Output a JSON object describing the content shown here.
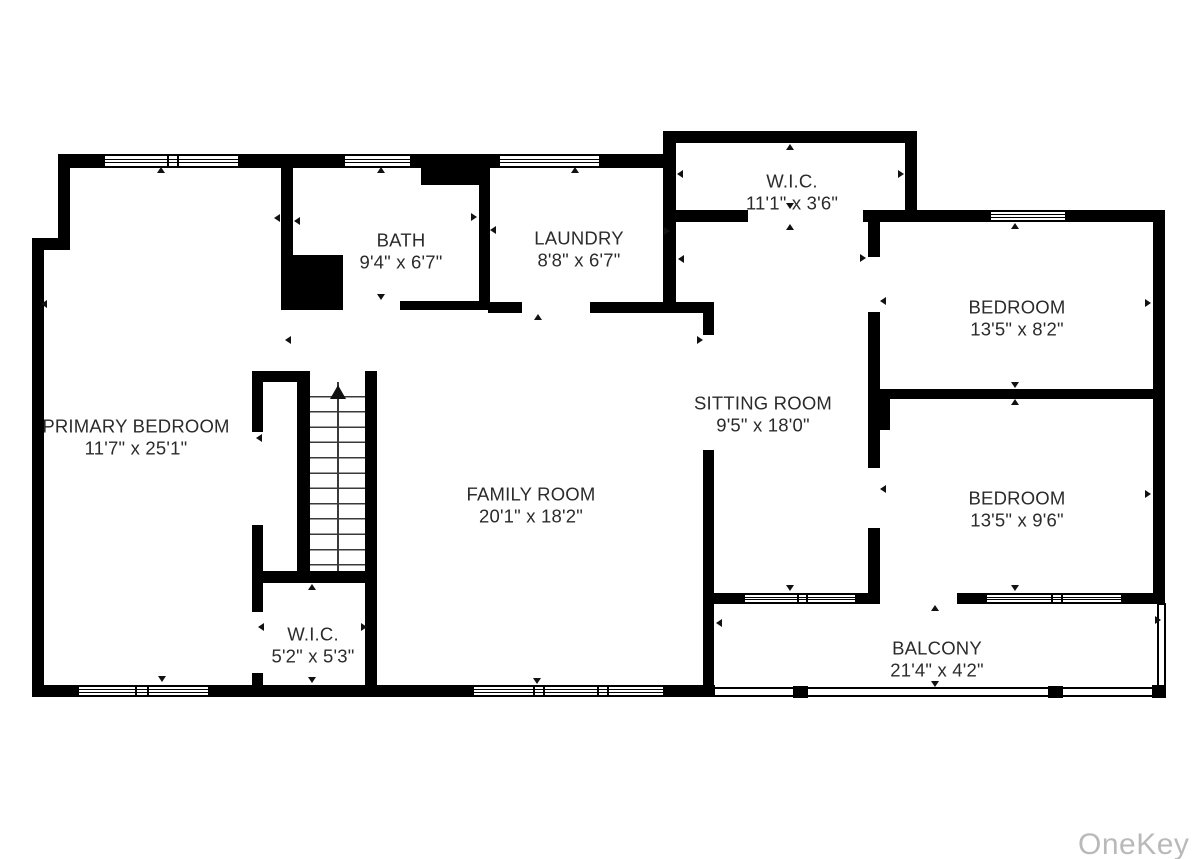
{
  "watermark": "OneKey MLS",
  "stairs": {
    "direction_icon": "up-arrow"
  },
  "rooms": {
    "primary_bedroom": {
      "name": "PRIMARY BEDROOM",
      "dims": "11'7\" x 25'1\""
    },
    "bath": {
      "name": "BATH",
      "dims": "9'4\" x 6'7\""
    },
    "laundry": {
      "name": "LAUNDRY",
      "dims": "8'8\" x 6'7\""
    },
    "wic_top": {
      "name": "W.I.C.",
      "dims": "11'1\" x 3'6\""
    },
    "sitting_room": {
      "name": "SITTING ROOM",
      "dims": "9'5\" x 18'0\""
    },
    "bedroom_1": {
      "name": "BEDROOM",
      "dims": "13'5\" x 8'2\""
    },
    "bedroom_2": {
      "name": "BEDROOM",
      "dims": "13'5\" x 9'6\""
    },
    "family_room": {
      "name": "FAMILY ROOM",
      "dims": "20'1\" x 18'2\""
    },
    "wic_small": {
      "name": "W.I.C.",
      "dims": "5'2\" x 5'3\""
    },
    "balcony": {
      "name": "BALCONY",
      "dims": "21'4\" x 4'2\""
    }
  },
  "colors": {
    "wall": "#000000",
    "label": "#2b2b2b",
    "watermark": "#b9b9b9"
  },
  "markers": [
    {
      "x": 161,
      "y": 170,
      "dir": "up"
    },
    {
      "x": 44,
      "y": 304,
      "dir": "left"
    },
    {
      "x": 162,
      "y": 679,
      "dir": "down"
    },
    {
      "x": 277,
      "y": 218,
      "dir": "left"
    },
    {
      "x": 381,
      "y": 170,
      "dir": "up"
    },
    {
      "x": 297,
      "y": 221,
      "dir": "left"
    },
    {
      "x": 474,
      "y": 217,
      "dir": "right"
    },
    {
      "x": 381,
      "y": 297,
      "dir": "down"
    },
    {
      "x": 575,
      "y": 170,
      "dir": "up"
    },
    {
      "x": 493,
      "y": 230,
      "dir": "left"
    },
    {
      "x": 667,
      "y": 231,
      "dir": "right"
    },
    {
      "x": 538,
      "y": 317,
      "dir": "up"
    },
    {
      "x": 790,
      "y": 147,
      "dir": "up"
    },
    {
      "x": 680,
      "y": 174,
      "dir": "left"
    },
    {
      "x": 901,
      "y": 174,
      "dir": "right"
    },
    {
      "x": 790,
      "y": 206,
      "dir": "down"
    },
    {
      "x": 790,
      "y": 227,
      "dir": "up"
    },
    {
      "x": 681,
      "y": 259,
      "dir": "left"
    },
    {
      "x": 863,
      "y": 258,
      "dir": "right"
    },
    {
      "x": 790,
      "y": 588,
      "dir": "down"
    },
    {
      "x": 1015,
      "y": 226,
      "dir": "up"
    },
    {
      "x": 883,
      "y": 301,
      "dir": "left"
    },
    {
      "x": 1148,
      "y": 303,
      "dir": "right"
    },
    {
      "x": 1015,
      "y": 385,
      "dir": "down"
    },
    {
      "x": 1015,
      "y": 402,
      "dir": "up"
    },
    {
      "x": 883,
      "y": 489,
      "dir": "left"
    },
    {
      "x": 1148,
      "y": 494,
      "dir": "right"
    },
    {
      "x": 1015,
      "y": 588,
      "dir": "down"
    },
    {
      "x": 935,
      "y": 608,
      "dir": "up"
    },
    {
      "x": 719,
      "y": 623,
      "dir": "left"
    },
    {
      "x": 1158,
      "y": 620,
      "dir": "right"
    },
    {
      "x": 935,
      "y": 684,
      "dir": "down"
    },
    {
      "x": 537,
      "y": 681,
      "dir": "down"
    },
    {
      "x": 312,
      "y": 587,
      "dir": "up"
    },
    {
      "x": 261,
      "y": 627,
      "dir": "left"
    },
    {
      "x": 364,
      "y": 627,
      "dir": "right"
    },
    {
      "x": 312,
      "y": 680,
      "dir": "down"
    },
    {
      "x": 288,
      "y": 340,
      "dir": "left"
    },
    {
      "x": 700,
      "y": 340,
      "dir": "right"
    },
    {
      "x": 259,
      "y": 438,
      "dir": "left"
    }
  ]
}
